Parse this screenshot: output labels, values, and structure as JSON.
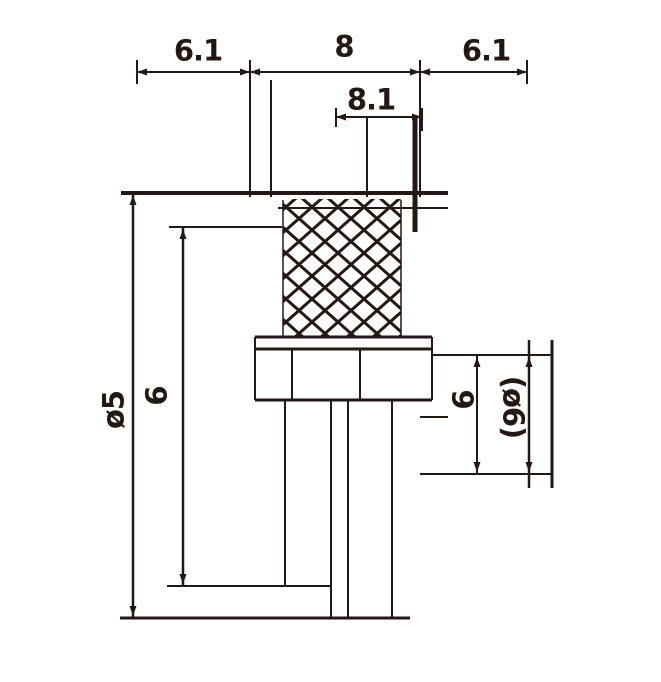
{
  "drawing": {
    "kind": "technical dimensional drawing of a threaded / spring component",
    "ink_color": "#231813",
    "background_color": "#ffffff",
    "labels": {
      "top_left_width": "6.1",
      "top_middle_width": "8",
      "top_right_width": "6.1",
      "upper_inner_width": "8.1",
      "left_outer_height": "ø5",
      "left_inner_height": "6",
      "right_inner_height": "6",
      "right_outer_height": "(ø6)"
    }
  }
}
